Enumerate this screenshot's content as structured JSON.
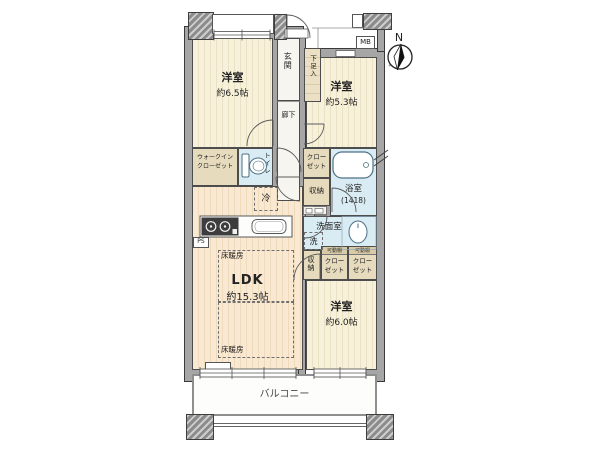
{
  "compass": {
    "north_label": "N"
  },
  "exterior": {
    "mb_label": "MB",
    "ps_label": "PS",
    "balcony_label": "バルコニー"
  },
  "rooms": {
    "bedroom_a": {
      "name": "洋室",
      "size": "約6.5帖"
    },
    "bedroom_b": {
      "name": "洋室",
      "size": "約5.3帖"
    },
    "bedroom_c": {
      "name": "洋室",
      "size": "約6.0帖"
    },
    "ldk": {
      "name": "LDK",
      "size": "約15.3帖"
    },
    "entrance": {
      "name": "玄関"
    },
    "hallway": {
      "name": "廊下"
    },
    "bath": {
      "name": "浴室",
      "size": "(1418)"
    },
    "washroom": {
      "name": "洗面室"
    }
  },
  "storage": {
    "shoe_cabinet": "下足入",
    "wic_line1": "ウォークイン",
    "wic_line2": "クローゼット",
    "closet_line1": "クロー",
    "closet_line2": "ゼット",
    "storage_label": "収納",
    "movable_shelf": "可動棚"
  },
  "fixtures": {
    "toilet_label": "トイレ",
    "fridge_label": "冷",
    "washer_label": "洗",
    "floor_heating": "床暖房"
  }
}
